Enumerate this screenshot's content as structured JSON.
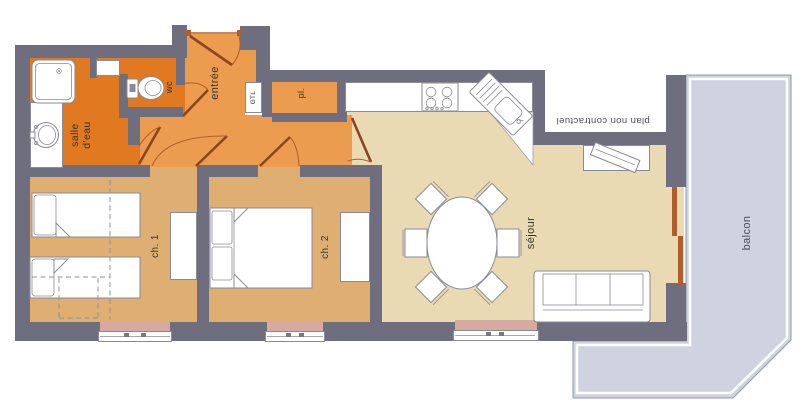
{
  "labels": {
    "salle_deau": "salle d'eau",
    "wc": "wc",
    "entree": "entrée",
    "gtl": "GTL",
    "placard": "pl.",
    "ch1": "ch. 1",
    "ch2": "ch. 2",
    "sejour": "séjour",
    "balcon": "balcon",
    "disclaimer": "plan non contractuel"
  },
  "colors": {
    "wall": "#6e6e7e",
    "orange_dark": "#e0791f",
    "orange_mid": "#eb9c4e",
    "tan": "#dfae72",
    "beige": "#e9dab3",
    "balcony": "#cfd3e0",
    "window_pink": "#d6a9a1",
    "door": "#8e4423",
    "sienna": "#b25d2b",
    "outline": "#8a8a96",
    "label": "#3a342e",
    "label_gray": "#4b4b55"
  }
}
